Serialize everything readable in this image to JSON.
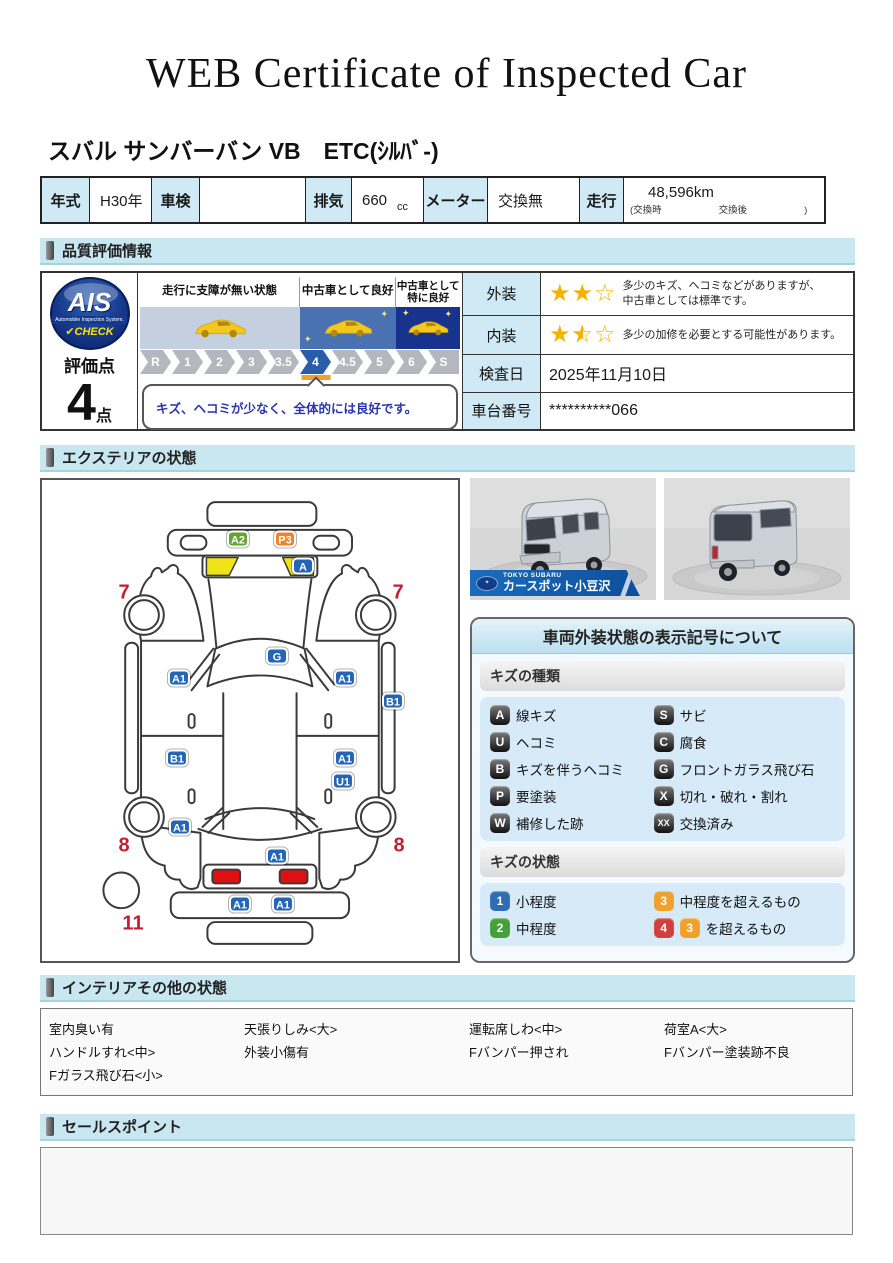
{
  "colors": {
    "section_bar_bg": "#c9e7f1",
    "table_head_bg": "#cfeaf4",
    "marker_blue": "#2565b5",
    "marker_green": "#63a532",
    "marker_orange": "#f08228",
    "red_number": "#c21f33",
    "star_yellow": "#f5b301",
    "active_segment_bg": "#2a5da8",
    "pointer_orange": "#f0a030",
    "state_blue": "#2e6db4",
    "state_green": "#44a038",
    "state_orange": "#f0a12c",
    "state_red": "#d04040"
  },
  "title": "WEB Certificate of Inspected Car",
  "vehicle": {
    "name": "スバル サンバーバン VB　ETC(ｼﾙﾊﾞ-)",
    "spec": {
      "year_label": "年式",
      "year_value": "H30年",
      "inspection_label": "車検",
      "inspection_value": "",
      "displacement_label": "排気",
      "displacement_value": "660",
      "displacement_unit": "cc",
      "meter_label": "メーター",
      "meter_value": "交換無",
      "mileage_label": "走行",
      "mileage_value": "48,596km",
      "mileage_note": "(交換時　　　　　　交換後　　　　　　)"
    }
  },
  "quality": {
    "section_title": "品質評価情報",
    "ais": {
      "logo_text": "AIS",
      "logo_subtext": "Automobile Inspection System.",
      "logo_check": "✔CHECK",
      "score_label": "評価点",
      "score_value": "4",
      "score_unit": "点"
    },
    "scale": {
      "zone_labels": [
        "走行に支障が無い状態",
        "中古車として良好",
        "中古車として\n特に良好"
      ],
      "segments": [
        "R",
        "1",
        "2",
        "3",
        "3.5",
        "4",
        "4.5",
        "5",
        "6",
        "S"
      ],
      "active_segment": "4",
      "comment": "キズ、ヘコミが少なく、全体的には良好です。"
    },
    "info": {
      "exterior_label": "外装",
      "exterior_stars": 2,
      "exterior_stars_total": 3,
      "exterior_text": "多少のキズ、ヘコミなどがありますが、\n中古車としては標準です。",
      "interior_label": "内装",
      "interior_stars": 1.5,
      "interior_stars_total": 3,
      "interior_text": "多少の加修を必要とする可能性があります。",
      "date_label": "検査日",
      "date_value": "2025年11月10日",
      "vin_label": "車台番号",
      "vin_value": "**********066"
    }
  },
  "exterior": {
    "section_title": "エクステリアの状態",
    "markers": [
      {
        "code": "A2",
        "color": "green",
        "x": 196,
        "y": 59
      },
      {
        "code": "P3",
        "color": "orange",
        "x": 243,
        "y": 59
      },
      {
        "code": "A",
        "color": "blue",
        "x": 261,
        "y": 86
      },
      {
        "code": "G",
        "color": "blue",
        "x": 235,
        "y": 176
      },
      {
        "code": "A1",
        "color": "blue",
        "x": 137,
        "y": 198
      },
      {
        "code": "A1",
        "color": "blue",
        "x": 303,
        "y": 198
      },
      {
        "code": "B1",
        "color": "blue",
        "x": 351,
        "y": 221
      },
      {
        "code": "B1",
        "color": "blue",
        "x": 135,
        "y": 278
      },
      {
        "code": "A1",
        "color": "blue",
        "x": 303,
        "y": 278
      },
      {
        "code": "U1",
        "color": "blue",
        "x": 301,
        "y": 301
      },
      {
        "code": "A1",
        "color": "blue",
        "x": 138,
        "y": 347
      },
      {
        "code": "A1",
        "color": "blue",
        "x": 235,
        "y": 376
      },
      {
        "code": "A1",
        "color": "blue",
        "x": 198,
        "y": 424
      },
      {
        "code": "A1",
        "color": "blue",
        "x": 241,
        "y": 424
      }
    ],
    "numbers": [
      {
        "text": "7",
        "x": 82,
        "y": 113
      },
      {
        "text": "7",
        "x": 356,
        "y": 113
      },
      {
        "text": "8",
        "x": 82,
        "y": 366
      },
      {
        "text": "8",
        "x": 357,
        "y": 366
      },
      {
        "text": "11",
        "x": 91,
        "y": 444
      }
    ],
    "photos": {
      "dealer_brand": "TOKYO SUBARU",
      "dealer_name": "カースポット小豆沢"
    },
    "legend": {
      "title": "車両外装状態の表示記号について",
      "kinds_title": "キズの種類",
      "kinds": [
        {
          "code": "A",
          "label": "線キズ"
        },
        {
          "code": "S",
          "label": "サビ"
        },
        {
          "code": "U",
          "label": "ヘコミ"
        },
        {
          "code": "C",
          "label": "腐食"
        },
        {
          "code": "B",
          "label": "キズを伴うヘコミ"
        },
        {
          "code": "G",
          "label": "フロントガラス飛び石"
        },
        {
          "code": "P",
          "label": "要塗装"
        },
        {
          "code": "X",
          "label": "切れ・破れ・割れ"
        },
        {
          "code": "W",
          "label": "補修した跡"
        },
        {
          "code": "XX",
          "label": "交換済み",
          "size": "xx"
        }
      ],
      "states_title": "キズの状態",
      "states": [
        {
          "badge": "1",
          "label": "小程度"
        },
        {
          "badge": "3",
          "label": "中程度を超えるもの"
        },
        {
          "badge": "2",
          "label": "中程度"
        },
        {
          "badge": "4",
          "badge2": "3",
          "label": "を超えるもの"
        }
      ]
    }
  },
  "interior": {
    "section_title": "インテリアその他の状態",
    "columns": [
      [
        "室内臭い有",
        "ハンドルすれ<中>",
        "Fガラス飛び石<小>"
      ],
      [
        "天張りしみ<大>",
        "外装小傷有"
      ],
      [
        "運転席しわ<中>",
        "Fバンパー押され"
      ],
      [
        "荷室A<大>",
        "Fバンパー塗装跡不良"
      ]
    ]
  },
  "sales": {
    "section_title": "セールスポイント",
    "content": ""
  }
}
